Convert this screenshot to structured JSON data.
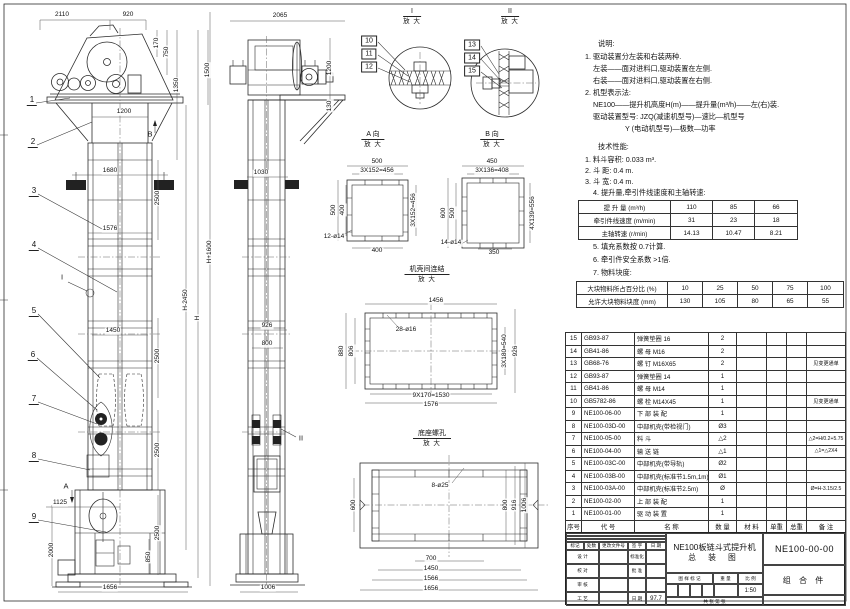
{
  "notes_lines": [
    {
      "t": "说明:",
      "x": 598,
      "y": 40
    },
    {
      "t": "1. 驱动装置分左装和右装两种.",
      "x": 585,
      "y": 53
    },
    {
      "t": "左装——面对进料口,驱动装置在左侧.",
      "x": 593,
      "y": 65
    },
    {
      "t": "右装——面对进料口,驱动装置在右侧.",
      "x": 593,
      "y": 77
    },
    {
      "t": "2. 机型表示法:",
      "x": 585,
      "y": 89
    },
    {
      "t": "NE100——提升机高度H(m)——提升量(m³/h)——左(右)装.",
      "x": 593,
      "y": 101
    },
    {
      "t": "驱动装置型号: JZQ(减速机型号)—速比—机型号",
      "x": 593,
      "y": 113
    },
    {
      "t": "Y (电动机型号)—极数—功率",
      "x": 625,
      "y": 125
    },
    {
      "t": "技术性能:",
      "x": 598,
      "y": 143
    },
    {
      "t": "1. 料斗容积: 0.033 m³.",
      "x": 585,
      "y": 156
    },
    {
      "t": "2. 斗  距: 0.4 m.",
      "x": 585,
      "y": 167
    },
    {
      "t": "3. 斗  宽: 0.4 m.",
      "x": 585,
      "y": 178
    },
    {
      "t": "4. 提升量,牵引件线速度和主轴转速:",
      "x": 593,
      "y": 189
    },
    {
      "t": "5. 填充系数按 0.7计算.",
      "x": 593,
      "y": 243
    },
    {
      "t": "6. 牵引件安全系数 >1倍.",
      "x": 593,
      "y": 256
    },
    {
      "t": "7. 物料块度:",
      "x": 593,
      "y": 269
    }
  ],
  "spec_table1": {
    "rows": [
      {
        "label": "提 升 量  (m³/h)",
        "v1": "110",
        "v2": "85",
        "v3": "66"
      },
      {
        "label": "牵引件线速度 (m/min)",
        "v1": "31",
        "v2": "23",
        "v3": "18"
      },
      {
        "label": "主轴转速 (r/min)",
        "v1": "14.13",
        "v2": "10.47",
        "v3": "8.21"
      }
    ]
  },
  "spec_table2": {
    "rows": [
      {
        "label": "大块物料所占百分比 (%)",
        "v1": "10",
        "v2": "25",
        "v3": "50",
        "v4": "75",
        "v5": "100"
      },
      {
        "label": "允许大块物料块度 (mm)",
        "v1": "130",
        "v2": "105",
        "v3": "80",
        "v4": "65",
        "v5": "55"
      }
    ]
  },
  "bom": {
    "headers": [
      "序号",
      "代  号",
      "名    称",
      "数 量",
      "材  料",
      "单重",
      "总重",
      "备  注"
    ],
    "rows": [
      {
        "no": "15",
        "code": "GB93-87",
        "name": "弹簧垫圈  16",
        "qty": "2",
        "mat": "",
        "uw": "",
        "tw": "",
        "rem": ""
      },
      {
        "no": "14",
        "code": "GB41-86",
        "name": "螺  母  M16",
        "qty": "2",
        "mat": "",
        "uw": "",
        "tw": "",
        "rem": ""
      },
      {
        "no": "13",
        "code": "GB68-76",
        "name": "螺  钉  M16X65",
        "qty": "2",
        "mat": "",
        "uw": "",
        "tw": "",
        "rem": "见变更通单"
      },
      {
        "no": "12",
        "code": "GB93-87",
        "name": "弹簧垫圈  14",
        "qty": "1",
        "mat": "",
        "uw": "",
        "tw": "",
        "rem": ""
      },
      {
        "no": "11",
        "code": "GB41-86",
        "name": "螺  母  M14",
        "qty": "1",
        "mat": "",
        "uw": "",
        "tw": "",
        "rem": ""
      },
      {
        "no": "10",
        "code": "GB5782-86",
        "name": "螺  栓  M14X45",
        "qty": "1",
        "mat": "",
        "uw": "",
        "tw": "",
        "rem": "见变更通单"
      },
      {
        "no": "9",
        "code": "NE100-06-00",
        "name": "下 部 装 配",
        "qty": "1",
        "mat": "",
        "uw": "",
        "tw": "",
        "rem": ""
      },
      {
        "no": "8",
        "code": "NE100-03D-00",
        "name": "中部机壳(带检视门)",
        "qty": "Ø3",
        "mat": "",
        "uw": "",
        "tw": "",
        "rem": ""
      },
      {
        "no": "7",
        "code": "NE100-05-00",
        "name": "料  斗",
        "qty": "△2",
        "mat": "",
        "uw": "",
        "tw": "",
        "rem": "△2=H/0.2+5.75"
      },
      {
        "no": "6",
        "code": "NE100-04-00",
        "name": "输 送 链",
        "qty": "△1",
        "mat": "",
        "uw": "",
        "tw": "",
        "rem": "△1=△2X4"
      },
      {
        "no": "5",
        "code": "NE100-03C-00",
        "name": "中部机壳(带导轨)",
        "qty": "Ø2",
        "mat": "",
        "uw": "",
        "tw": "",
        "rem": ""
      },
      {
        "no": "4",
        "code": "NE100-03B-00",
        "name": "中部机壳(标准节1.5m,1m)",
        "qty": "Ø1",
        "mat": "",
        "uw": "",
        "tw": "",
        "rem": ""
      },
      {
        "no": "3",
        "code": "NE100-03A-00",
        "name": "中部机壳(标准节2.5m)",
        "qty": "Ø",
        "mat": "",
        "uw": "",
        "tw": "",
        "rem": "Ø=H-3.15/2.5"
      },
      {
        "no": "2",
        "code": "NE100-02-00",
        "name": "上 部 装 配",
        "qty": "1",
        "mat": "",
        "uw": "",
        "tw": "",
        "rem": ""
      },
      {
        "no": "1",
        "code": "NE100-01-00",
        "name": "驱 动 装 置",
        "qty": "1",
        "mat": "",
        "uw": "",
        "tw": "",
        "rem": ""
      }
    ]
  },
  "titleblock": {
    "mark": "标记",
    "count": "处数",
    "doc": "更改文件号",
    "sign": "签 字",
    "date_label": "日 期",
    "design": "设 计",
    "standardize": "标准化",
    "check": "校 对",
    "approve": "批 准",
    "review": "审 核",
    "process": "工 艺",
    "date_value": "97.7",
    "stamp_label": "图 样 标 记",
    "weight_label": "重 量",
    "scale_label": "比 例",
    "scale_value": "1:50",
    "sheets": "共    张    第    张",
    "title1": "NE100板链斗式提升机",
    "title2": "总 装 图",
    "drawing_no": "NE100-00-00",
    "item_type": "组 合 件"
  },
  "dims": [
    {
      "t": "2110",
      "x": 62,
      "y": 15
    },
    {
      "t": "920",
      "x": 128,
      "y": 15
    },
    {
      "t": "170",
      "x": 157,
      "y": 43,
      "r": -90
    },
    {
      "t": "750",
      "x": 167,
      "y": 52,
      "r": -90
    },
    {
      "t": "1350",
      "x": 177,
      "y": 85,
      "r": -90
    },
    {
      "t": "1500",
      "x": 208,
      "y": 70,
      "r": -90
    },
    {
      "t": "1200",
      "x": 124,
      "y": 112
    },
    {
      "t": "1680",
      "x": 110,
      "y": 171
    },
    {
      "t": "2500",
      "x": 158,
      "y": 198,
      "r": -90
    },
    {
      "t": "1576",
      "x": 110,
      "y": 229
    },
    {
      "t": "H+1600",
      "x": 210,
      "y": 252,
      "r": -90
    },
    {
      "t": "H-2450",
      "x": 186,
      "y": 300,
      "r": -90
    },
    {
      "t": "H",
      "x": 198,
      "y": 318,
      "r": -90
    },
    {
      "t": "1450",
      "x": 113,
      "y": 331
    },
    {
      "t": "2500",
      "x": 158,
      "y": 356,
      "r": -90
    },
    {
      "t": "2500",
      "x": 158,
      "y": 450,
      "r": -90
    },
    {
      "t": "2500",
      "x": 158,
      "y": 533,
      "r": -90
    },
    {
      "t": "1125",
      "x": 60,
      "y": 503
    },
    {
      "t": "2000",
      "x": 52,
      "y": 550,
      "r": -90
    },
    {
      "t": "850",
      "x": 149,
      "y": 557,
      "r": -90
    },
    {
      "t": "1656",
      "x": 110,
      "y": 588
    },
    {
      "t": "2065",
      "x": 280,
      "y": 16
    },
    {
      "t": "1200",
      "x": 330,
      "y": 68,
      "r": -90
    },
    {
      "t": "130",
      "x": 330,
      "y": 106,
      "r": -90
    },
    {
      "t": "1030",
      "x": 261,
      "y": 173
    },
    {
      "t": "926",
      "x": 267,
      "y": 326
    },
    {
      "t": "800",
      "x": 267,
      "y": 344
    },
    {
      "t": "1006",
      "x": 268,
      "y": 588
    },
    {
      "t": "500",
      "x": 377,
      "y": 162
    },
    {
      "t": "3X152=456",
      "x": 377,
      "y": 171
    },
    {
      "t": "500",
      "x": 334,
      "y": 210,
      "r": -90
    },
    {
      "t": "400",
      "x": 343,
      "y": 210,
      "r": -90
    },
    {
      "t": "3X152=456",
      "x": 414,
      "y": 210,
      "r": -90
    },
    {
      "t": "12-ø14",
      "x": 334,
      "y": 237
    },
    {
      "t": "400",
      "x": 377,
      "y": 251
    },
    {
      "t": "450",
      "x": 492,
      "y": 162
    },
    {
      "t": "3X136=408",
      "x": 492,
      "y": 171
    },
    {
      "t": "600",
      "x": 444,
      "y": 213,
      "r": -90
    },
    {
      "t": "500",
      "x": 453,
      "y": 213,
      "r": -90
    },
    {
      "t": "4X139=556",
      "x": 533,
      "y": 213,
      "r": -90
    },
    {
      "t": "14-ø14",
      "x": 451,
      "y": 243
    },
    {
      "t": "350",
      "x": 494,
      "y": 253
    },
    {
      "t": "1456",
      "x": 436,
      "y": 301
    },
    {
      "t": "28-ø16",
      "x": 406,
      "y": 330
    },
    {
      "t": "880",
      "x": 342,
      "y": 351,
      "r": -90
    },
    {
      "t": "806",
      "x": 352,
      "y": 351,
      "r": -90
    },
    {
      "t": "3X180=540",
      "x": 505,
      "y": 351,
      "r": -90
    },
    {
      "t": "926",
      "x": 516,
      "y": 351,
      "r": -90
    },
    {
      "t": "9X170=1530",
      "x": 431,
      "y": 396
    },
    {
      "t": "1576",
      "x": 431,
      "y": 405
    },
    {
      "t": "8-ø25",
      "x": 440,
      "y": 486
    },
    {
      "t": "600",
      "x": 354,
      "y": 505,
      "r": -90
    },
    {
      "t": "800",
      "x": 506,
      "y": 505,
      "r": -90
    },
    {
      "t": "916",
      "x": 515,
      "y": 505,
      "r": -90
    },
    {
      "t": "1006",
      "x": 525,
      "y": 505,
      "r": -90
    },
    {
      "t": "700",
      "x": 431,
      "y": 559
    },
    {
      "t": "1450",
      "x": 431,
      "y": 569
    },
    {
      "t": "1566",
      "x": 431,
      "y": 579
    },
    {
      "t": "1656",
      "x": 431,
      "y": 589
    }
  ],
  "balloons": [
    {
      "t": "1",
      "x": 32,
      "y": 101
    },
    {
      "t": "2",
      "x": 33,
      "y": 143
    },
    {
      "t": "3",
      "x": 34,
      "y": 192
    },
    {
      "t": "4",
      "x": 34,
      "y": 246
    },
    {
      "t": "5",
      "x": 34,
      "y": 312
    },
    {
      "t": "6",
      "x": 33,
      "y": 356
    },
    {
      "t": "7",
      "x": 34,
      "y": 400
    },
    {
      "t": "8",
      "x": 34,
      "y": 457
    },
    {
      "t": "9",
      "x": 34,
      "y": 518
    }
  ],
  "boxed_balloons": [
    {
      "t": "10",
      "x": 369,
      "y": 41
    },
    {
      "t": "11",
      "x": 369,
      "y": 54
    },
    {
      "t": "12",
      "x": 369,
      "y": 67
    },
    {
      "t": "13",
      "x": 472,
      "y": 45
    },
    {
      "t": "14",
      "x": 472,
      "y": 58
    },
    {
      "t": "15",
      "x": 472,
      "y": 71
    }
  ],
  "marks": [
    {
      "t": "A",
      "x": 66,
      "y": 486
    },
    {
      "t": "B",
      "x": 150,
      "y": 134
    },
    {
      "t": "I",
      "x": 62,
      "y": 277
    },
    {
      "t": "II",
      "x": 301,
      "y": 438
    }
  ],
  "view_labels": [
    {
      "a": "I",
      "b": "放 大",
      "x": 412,
      "y": 8
    },
    {
      "a": "II",
      "b": "放 大",
      "x": 510,
      "y": 8
    },
    {
      "a": "A 向",
      "b": "放 大",
      "x": 373,
      "y": 131
    },
    {
      "a": "B 向",
      "b": "放 大",
      "x": 492,
      "y": 131
    },
    {
      "a": "机壳间连结",
      "b": "放 大",
      "x": 427,
      "y": 266
    },
    {
      "a": "底座螺孔",
      "b": "放 大",
      "x": 432,
      "y": 430
    }
  ]
}
